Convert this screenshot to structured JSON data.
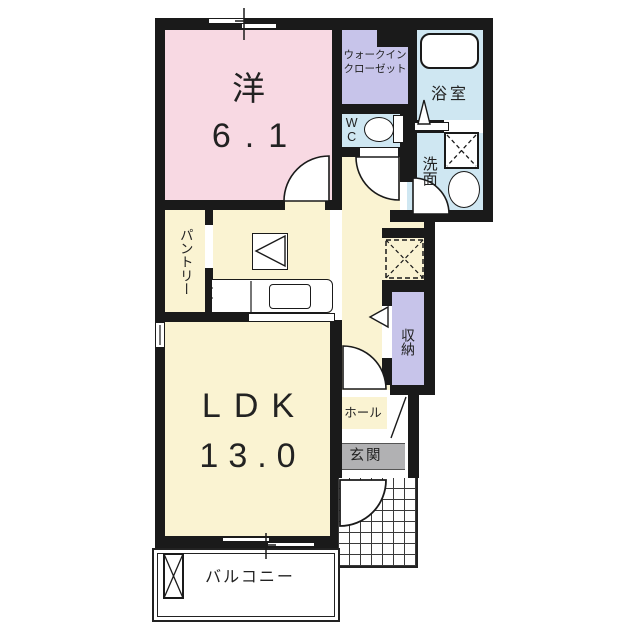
{
  "plan_title": "1LDK apartment floor plan",
  "rooms": {
    "western": {
      "label": "洋",
      "size": "6.1"
    },
    "walk_in_closet": {
      "line1": "ウォークイン",
      "line2": "クローゼット"
    },
    "bath": {
      "label": "浴室"
    },
    "toilet": {
      "label": "WC"
    },
    "washroom": {
      "label": "洗面"
    },
    "pantry": {
      "label": "パントリー"
    },
    "ldk": {
      "label": "LDK",
      "size": "13.0"
    },
    "storage": {
      "label": "収納"
    },
    "hall": {
      "label": "ホール"
    },
    "entrance": {
      "label": "玄関"
    },
    "balcony": {
      "label": "バルコニー"
    }
  },
  "colors": {
    "wall": "#1a1a1a",
    "western_room": "#f8d9e3",
    "closet": "#c7c4ea",
    "wet_area": "#cfe7f2",
    "living": "#faf3d2",
    "entrance_floor": "#b1b1b3"
  }
}
